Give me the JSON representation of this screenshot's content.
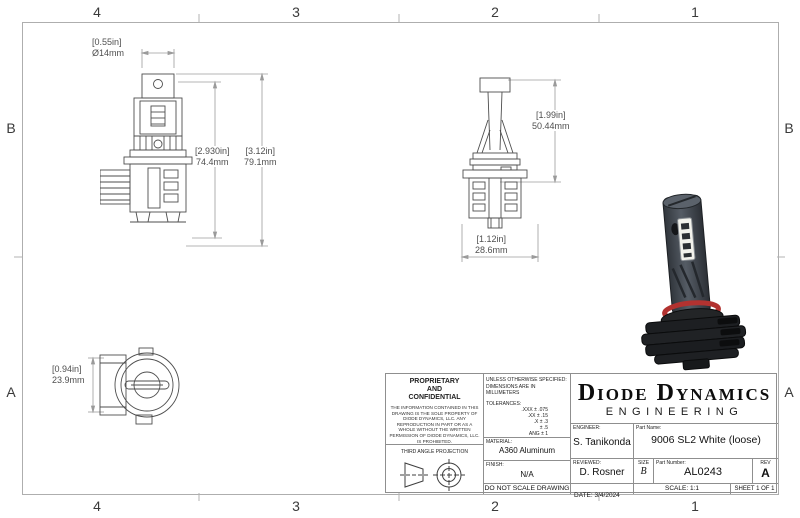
{
  "zones": {
    "cols": [
      "4",
      "3",
      "2",
      "1"
    ],
    "rows": [
      "B",
      "A"
    ]
  },
  "dims": {
    "cap_diameter": {
      "in": "[0.55in]",
      "mm": "Ø14mm"
    },
    "body_height": {
      "in": "[2.930in]",
      "mm": "74.4mm"
    },
    "overall_height": {
      "in": "[3.12in]",
      "mm": "79.1mm"
    },
    "upper_height": {
      "in": "[1.99in]",
      "mm": "50.44mm"
    },
    "base_width": {
      "in": "[1.12in]",
      "mm": "28.6mm"
    },
    "base_depth": {
      "in": "[0.94in]",
      "mm": "23.9mm"
    }
  },
  "title_block": {
    "proprietary_heading": [
      "PROPRIETARY",
      "AND",
      "CONFIDENTIAL"
    ],
    "proprietary_body": "THE INFORMATION CONTAINED IN THIS DRAWING IS THE SOLE PROPERTY OF DIODE DYNAMICS, LLC.  ANY REPRODUCTION IN PART OR AS A WHOLE WITHOUT THE WRITTEN PERMISSION OF DIODE DYNAMICS, LLC. IS PROHIBITED.",
    "projection_label": "THIRD ANGLE PROJECTION",
    "spec_note_1": "UNLESS OTHERWISE SPECIFIED:",
    "spec_note_2": "DIMENSIONS ARE IN MILLIMETERS",
    "tolerances_heading": "TOLERANCES:",
    "tolerances": [
      ".XXX ± .075",
      ".XX ± .15",
      ".X ± .3",
      "± .5",
      "ANG ± 1"
    ],
    "material_label": "MATERIAL:",
    "material": "A360 Aluminum",
    "finish_label": "FINISH:",
    "finish": "N/A",
    "do_not_scale": "DO NOT SCALE DRAWING",
    "company": "Diode Dynamics",
    "company_sub": "ENGINEERING",
    "engineer_label": "ENGINEER:",
    "engineer": "S. Tanikonda",
    "part_name_label": "Part Name:",
    "part_name": "9006 SL2 White (loose)",
    "reviewed_label": "REVIEWED:",
    "reviewed": "D. Rosner",
    "size_label": "SIZE",
    "size": "B",
    "part_number_label": "Part Number:",
    "part_number": "AL0243",
    "rev_label": "REV",
    "rev": "A",
    "date_label": "DATE:",
    "date": "3/4/2024",
    "scale": "SCALE: 1:1",
    "sheet": "SHEET 1 OF 1"
  },
  "colors": {
    "line": "#4e4e4e",
    "dim_line": "#9b9b9b",
    "oring_red": "#b23230",
    "bulb_black": "#1d1f21"
  }
}
